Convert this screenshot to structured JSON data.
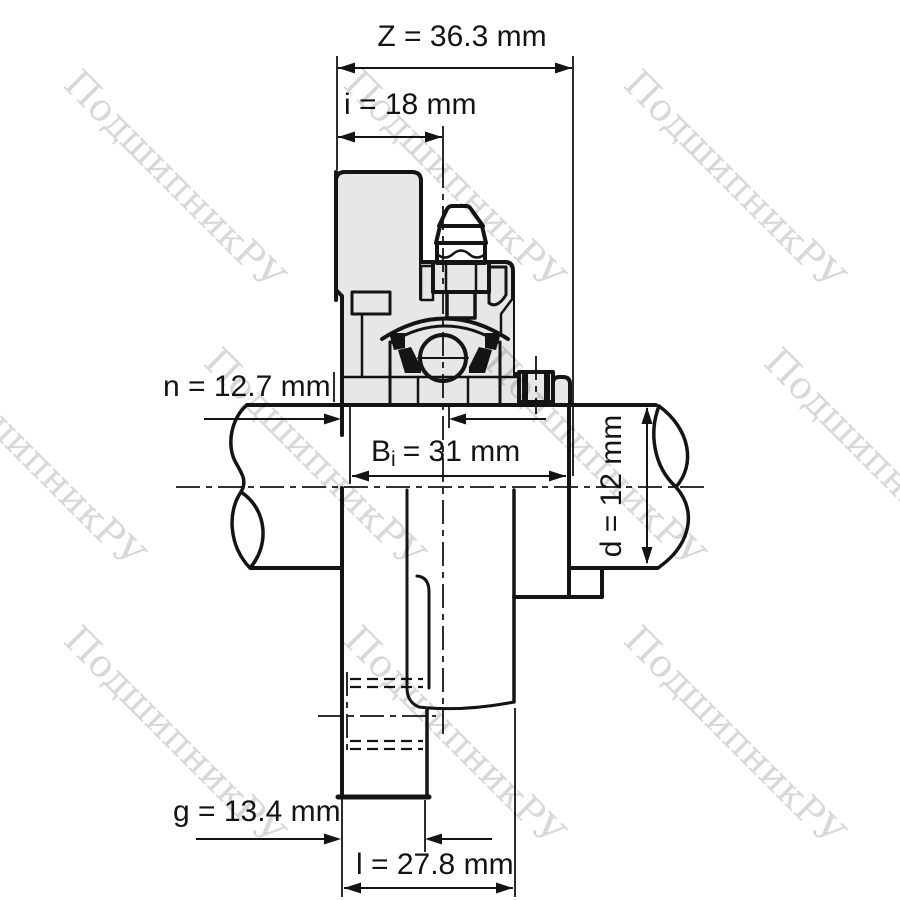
{
  "meta": {
    "description": "Flanged bearing unit cross-section technical drawing",
    "view": "side section with broken shaft"
  },
  "watermark": {
    "text": "ПодшипникРУ"
  },
  "dimensions": {
    "z": {
      "name": "Z",
      "value": 36.3,
      "unit": "mm",
      "label": "Z = 36.3 mm"
    },
    "i": {
      "name": "i",
      "value": 18,
      "unit": "mm",
      "label": "i = 18 mm"
    },
    "n": {
      "name": "n",
      "value": 12.7,
      "unit": "mm",
      "label": "n = 12.7 mm"
    },
    "bi": {
      "name": "Bi",
      "value": 31,
      "unit": "mm",
      "label": "Bi = 31 mm",
      "prefix": "B",
      "sub": "i",
      "rest": "= 31 mm"
    },
    "d": {
      "name": "d",
      "value": 12,
      "unit": "mm",
      "label": "d = 12 mm"
    },
    "g": {
      "name": "g",
      "value": 13.4,
      "unit": "mm",
      "label": "g = 13.4 mm"
    },
    "l": {
      "name": "l",
      "value": 27.8,
      "unit": "mm",
      "label": "l = 27.8 mm"
    }
  },
  "colors": {
    "line": "#141414",
    "metal_section": "#e7e7e7",
    "background": "#ffffff"
  }
}
